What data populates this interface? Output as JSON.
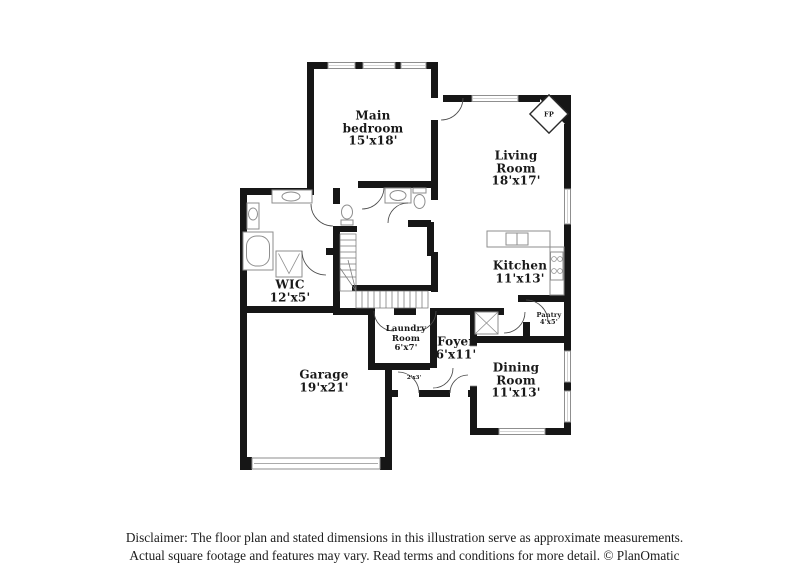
{
  "rooms": {
    "main_bedroom": {
      "name": "Main bedroom",
      "dims": "15'x18'"
    },
    "living_room": {
      "name": "Living Room",
      "dims": "18'x17'"
    },
    "kitchen": {
      "name": "Kitchen",
      "dims": "11'x13'"
    },
    "wic": {
      "name": "WIC",
      "dims": "12'x5'"
    },
    "laundry_room": {
      "name": "Laundry Room",
      "dims": "6'x7'"
    },
    "foyer": {
      "name": "Foyer",
      "dims": "6'x11'"
    },
    "garage": {
      "name": "Garage",
      "dims": "19'x21'"
    },
    "dining_room": {
      "name": "Dining Room",
      "dims": "11'x13'"
    },
    "pantry": {
      "name": "Pantry",
      "dims": "4'x5'"
    },
    "hall": {
      "dims": "2'x3'"
    },
    "fireplace": {
      "abbr": "FP"
    }
  },
  "footer": {
    "line1": "Disclaimer: The floor plan and stated dimensions in this illustration serve as approximate measurements.",
    "line2": "Actual square footage and features may vary. Read terms and conditions for more detail. © PlanOmatic"
  },
  "colors": {
    "wall": "#161616",
    "window_stroke": "#8f8f8f",
    "fixture_stroke": "#8e8e8e",
    "label_text": "#191919"
  }
}
